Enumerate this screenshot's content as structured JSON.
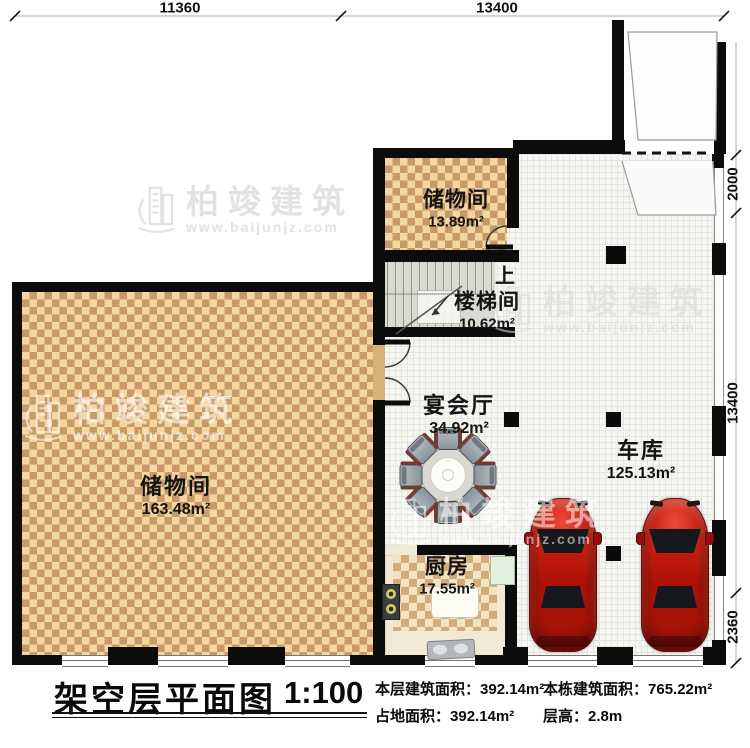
{
  "dimensions": {
    "top": [
      "11360",
      "13400"
    ],
    "right": [
      "2000",
      "13400",
      "2360"
    ]
  },
  "rooms": {
    "storage_top": {
      "name": "储物间",
      "area": "13.89m²"
    },
    "stairwell": {
      "name": "楼梯间",
      "area": "10.62m²"
    },
    "banquet": {
      "name": "宴会厅",
      "area": "34.92m²"
    },
    "garage": {
      "name": "车库",
      "area": "125.13m²"
    },
    "storage_big": {
      "name": "储物间",
      "area": "163.48m²"
    },
    "kitchen": {
      "name": "厨房",
      "area": "17.55m²"
    }
  },
  "stairs": {
    "up_label": "上"
  },
  "title_block": {
    "title": "架空层平面图",
    "scale": "1:100",
    "stats": [
      {
        "label": "本层建筑面积：",
        "value": "392.14m²"
      },
      {
        "label": "本栋建筑面积：",
        "value": "765.22m²"
      },
      {
        "label": "占地面积：",
        "value": "392.14m²"
      },
      {
        "label": "层高：",
        "value": "2.8m"
      }
    ]
  },
  "watermark": {
    "brand": "柏竣建筑",
    "url": "www.baijunjz.com"
  },
  "colors": {
    "wall": "#0c0c0c",
    "floor_dark": "#c9996a",
    "floor_light": "#f4d79f",
    "car": "#c02012"
  }
}
